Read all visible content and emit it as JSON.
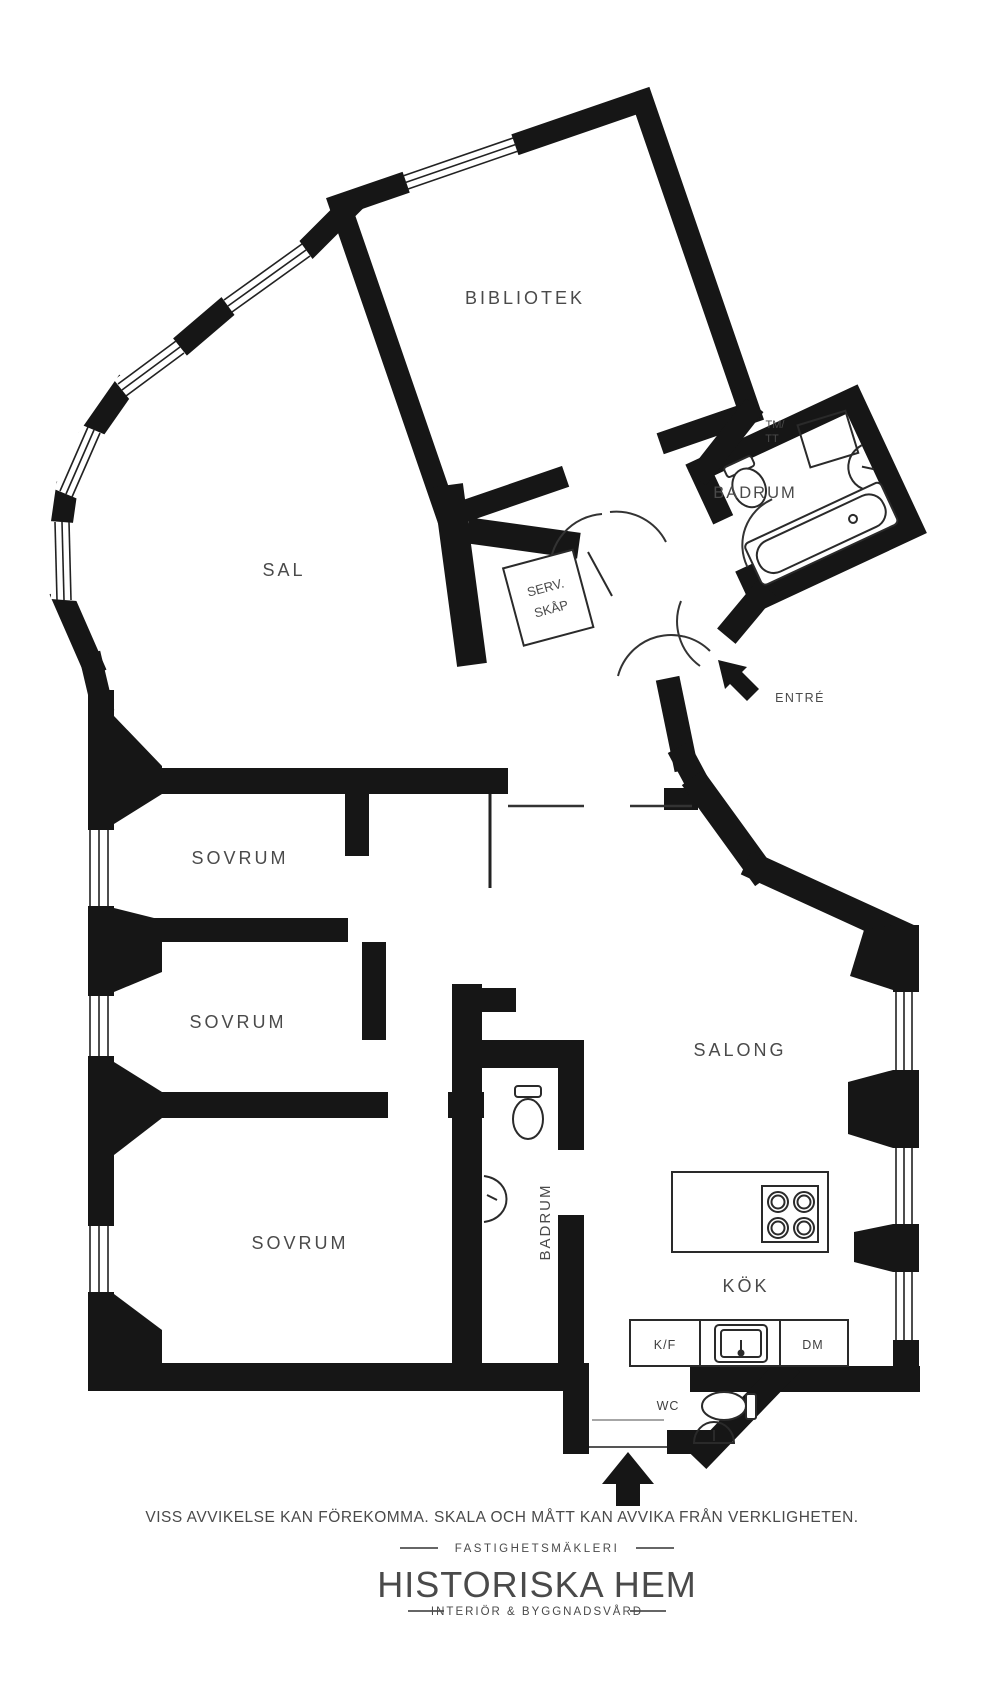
{
  "plan": {
    "colors": {
      "wall": "#161616",
      "label": "#4a4a4a",
      "fixture": "#2a2a2a",
      "background": "#ffffff"
    },
    "rooms": {
      "bibliotek": "BIBLIOTEK",
      "sal": "SAL",
      "badrum_top": "BADRUM",
      "sovrum_1": "SOVRUM",
      "sovrum_2": "SOVRUM",
      "sovrum_3": "SOVRUM",
      "badrum_mid": "BADRUM",
      "salong": "SALONG",
      "kok": "KÖK"
    },
    "fixtures": {
      "tm_tt_line1": "TM/",
      "tm_tt_line2": "TT",
      "serv_skap_line1": "SERV.",
      "serv_skap_line2": "SKÅP",
      "kf": "K/F",
      "dm": "DM",
      "wc": "WC"
    },
    "entrance": {
      "entre": "ENTRÉ"
    }
  },
  "footer": {
    "disclaimer": "VISS AVVIKELSE KAN FÖREKOMMA. SKALA OCH MÅTT KAN AVVIKA FRÅN VERKLIGHETEN.",
    "brand": {
      "tagline_top": "FASTIGHETSMÄKLERI",
      "name": "HISTORISKA HEM",
      "tagline_bottom": "INTERIÖR & BYGGNADSVÅRD"
    }
  }
}
